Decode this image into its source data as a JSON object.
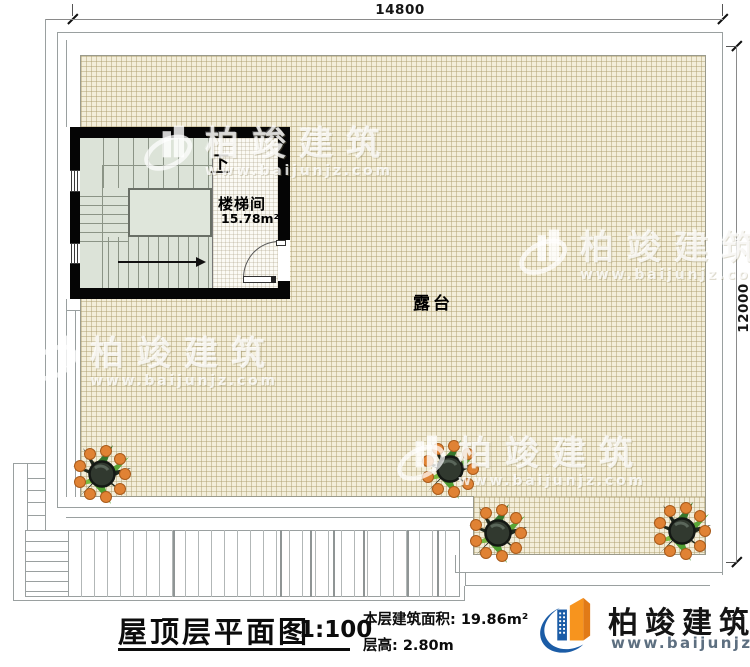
{
  "dimensions": {
    "top": "14800",
    "right": "12000"
  },
  "rooms": {
    "stairwell": {
      "label": "楼梯间",
      "area": "15.78m²",
      "direction_label": "下"
    },
    "terrace": {
      "label": "露台"
    }
  },
  "watermark": {
    "brand": "柏竣建筑",
    "website": "www.baijunjz.com"
  },
  "title_block": {
    "title": "屋顶层平面图",
    "scale": "1:100",
    "area_text": "本层建筑面积: 19.86m²",
    "height_text": "层高: 2.80m"
  },
  "brand": {
    "name": "柏竣建筑",
    "website": "www.baijunjz.com"
  },
  "colors": {
    "terrace_fill": "#f3eeda",
    "wall": "#050505",
    "stair_fill": "#dce3d8",
    "logo_blue": "#1b5ca6",
    "logo_orange": "#f7941e",
    "berry_orange": "#e08234"
  }
}
